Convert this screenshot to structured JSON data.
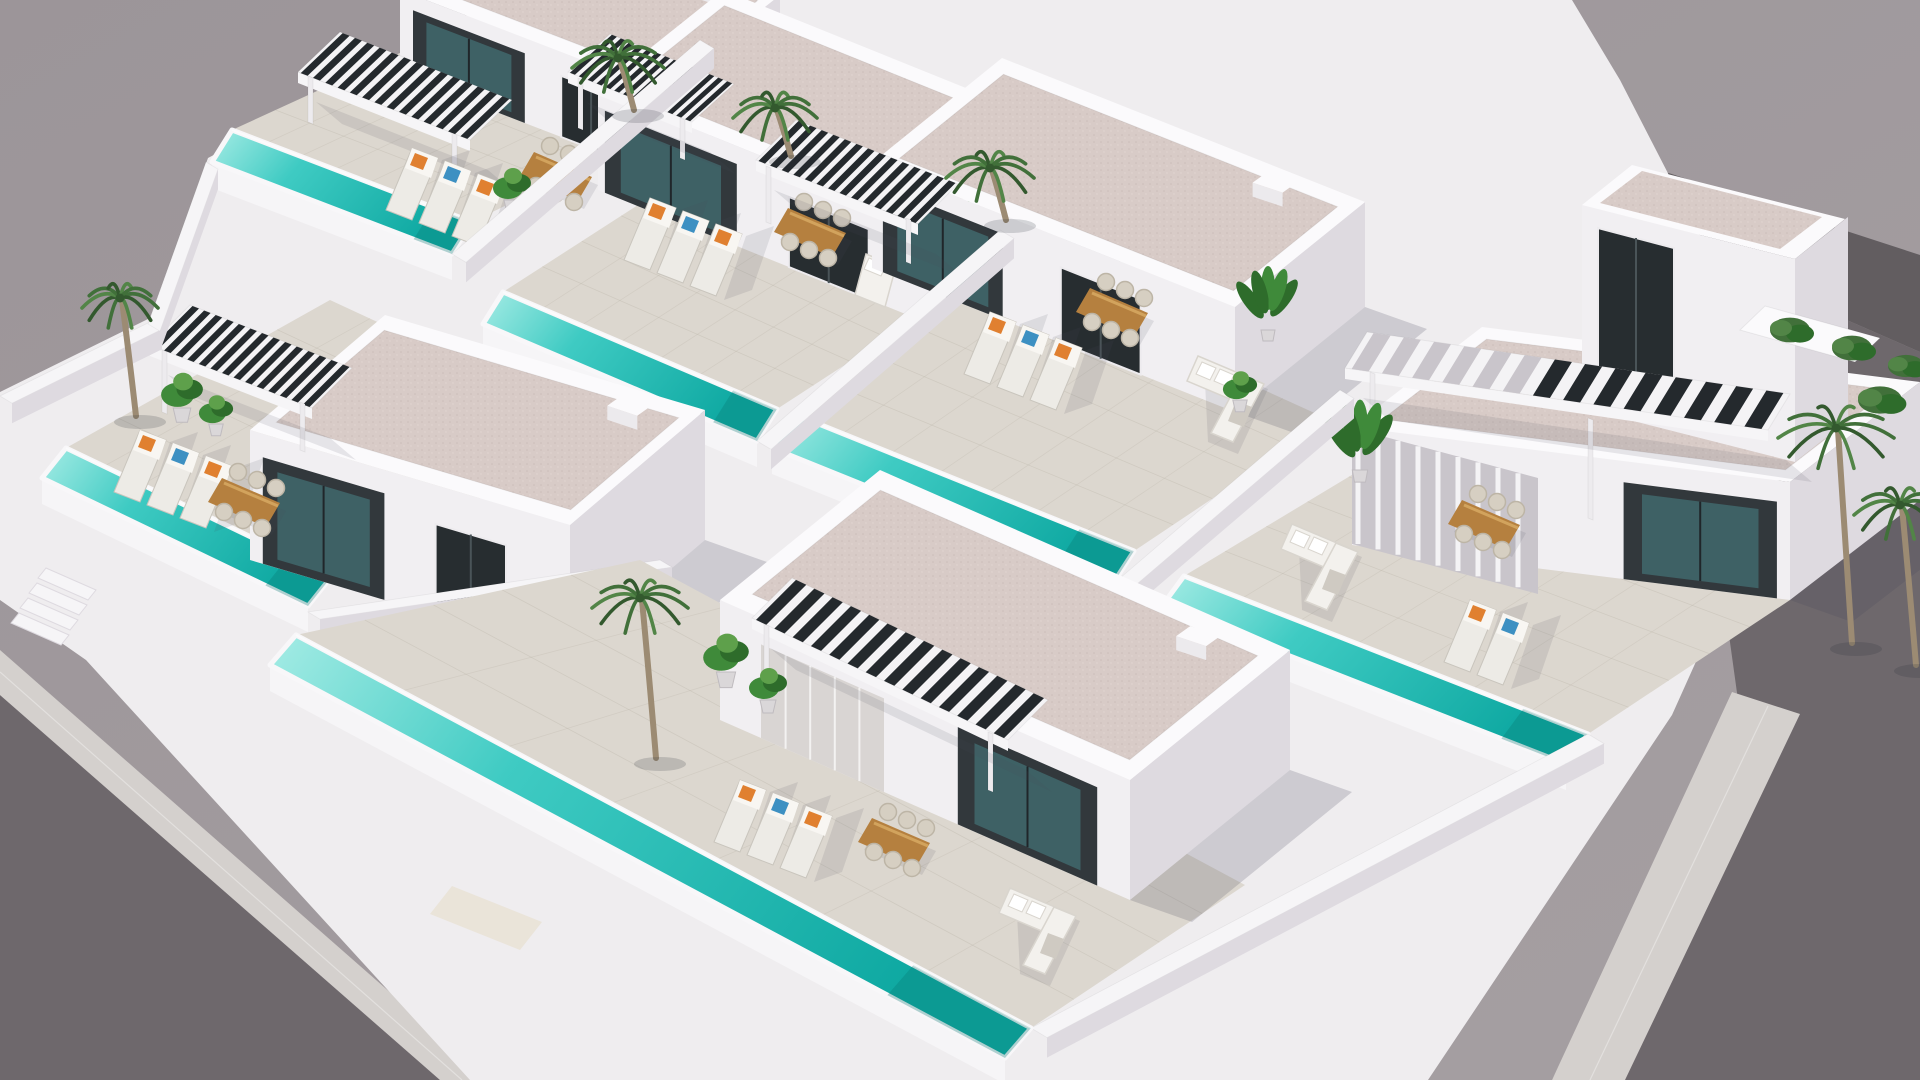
{
  "image": {
    "kind": "3D architectural aerial rendering",
    "subject": "Gated development of modern white Mediterranean villas, each with a private turquoise pool, tiled sun terrace, slatted pergola and outdoor furniture, surrounded by asphalt roads with pale sidewalks and palm trees",
    "view": "high oblique bird's-eye view",
    "villa_count": 6
  },
  "colors": {
    "backdrop": "#9C9599",
    "backdropLight": "#A59FA2",
    "roadDark": "#6E686C",
    "roadDarker": "#625D60",
    "sidewalk": "#D4D0CD",
    "hull": "#EFEDEF",
    "wallLit": "#F6F5F7",
    "wallMid": "#ECEAED",
    "wallShade": "#DEDAE0",
    "wallTop": "#FBFAFC",
    "houseFront": "#F1EFF2",
    "roofPink": "#D8CBC7",
    "roofDot1": "#CBBDB9",
    "roofDot2": "#E2D6D2",
    "terrace": "#DCD7CF",
    "tileLine": "#B9B3A7",
    "poolShallow": "#A5ECE5",
    "poolMid": "#3FCBC3",
    "poolDeep": "#0FA9A2",
    "poolEdgeDark": "#0A827C",
    "coping": "#F8F7F9",
    "facadeDark": "#32383C",
    "glassDark": "#272D30",
    "glassTeal": "#3E6165",
    "curtain": "#D9D5D3",
    "slatDark": "#24292D",
    "slatWhite": "#F4F3F5",
    "louverGap": "#C9C5CB",
    "wood": "#B5803F",
    "woodLight": "#D2A35D",
    "sofa": "#F3F1ED",
    "sofaShade": "#D9D5CE",
    "lounger": "#EDEBE6",
    "loungerEdge": "#C9C5BD",
    "pillowOrange": "#E08030",
    "pillowBlue": "#3D90C2",
    "plant": "#3F8A3A",
    "plantDark": "#2E6C2B",
    "plantLight": "#5EA04B",
    "palm": "#41703A",
    "palmDark": "#33592E",
    "palmLight": "#528547",
    "trunk": "#9C8B73",
    "pot": "#DAD7D9",
    "potEdge": "#BFBBBF",
    "shadow": "rgba(70,72,88,0.20)",
    "softShadow": "rgba(70,72,88,0.12)",
    "entrance": "#EAE4D9"
  },
  "scene": {
    "roads": [
      "asphalt street along lower-left edge",
      "asphalt street along right edge",
      "asphalt street behind upper-right corner"
    ],
    "sidewalks": [
      "pale paved sidewalk strip along lower-left street",
      "pale paved sidewalk strip along right street"
    ],
    "development": {
      "perimeter": "white rendered walls around every plot",
      "villas": [
        {
          "id": "villa-1",
          "position": "back row far left",
          "storeys": 1,
          "features": [
            "private pool",
            "dark slatted pergola",
            "sun loungers with orange and blue cushions",
            "wooden dining set",
            "potted plant",
            "speckled flat roof"
          ]
        },
        {
          "id": "villa-2",
          "position": "back row centre left",
          "storeys": 1,
          "features": [
            "private pool",
            "dark slatted pergola",
            "sun loungers",
            "wooden dining set",
            "day bed",
            "tall potted plant",
            "speckled flat roof"
          ]
        },
        {
          "id": "villa-3",
          "position": "back row centre right",
          "storeys": 1,
          "features": [
            "private pool",
            "dark slatted pergola",
            "sun loungers",
            "wooden dining set",
            "white corner sofa",
            "potted plants",
            "speckled flat roof"
          ]
        },
        {
          "id": "villa-4",
          "position": "far right",
          "storeys": 2,
          "features": [
            "tower volume with large dark window",
            "roof terrace balcony",
            "pergola with white and dark slats",
            "white louver screen",
            "private pool",
            "wooden dining set",
            "white corner sofa",
            "sun loungers",
            "speckled flat roof"
          ]
        },
        {
          "id": "villa-5",
          "position": "middle left",
          "storeys": 1,
          "features": [
            "private pool",
            "dark slatted pergola",
            "sun loungers",
            "wooden dining set",
            "potted plants",
            "garden tree",
            "street steps",
            "speckled flat roof"
          ]
        },
        {
          "id": "villa-6",
          "position": "front centre",
          "storeys": 1,
          "features": [
            "long private pool",
            "dark slatted pergola",
            "sun loungers",
            "wooden dining set",
            "large white corner sofa",
            "potted plants",
            "palm tree",
            "speckled flat roof"
          ]
        }
      ]
    },
    "vegetation": {
      "palm_trees": 6,
      "garden_tree": 1,
      "hedge_bushes": 4,
      "potted_plants": "several on each terrace"
    },
    "lighting": "bright sunlight from upper left with soft shadows cast to the lower right"
  }
}
